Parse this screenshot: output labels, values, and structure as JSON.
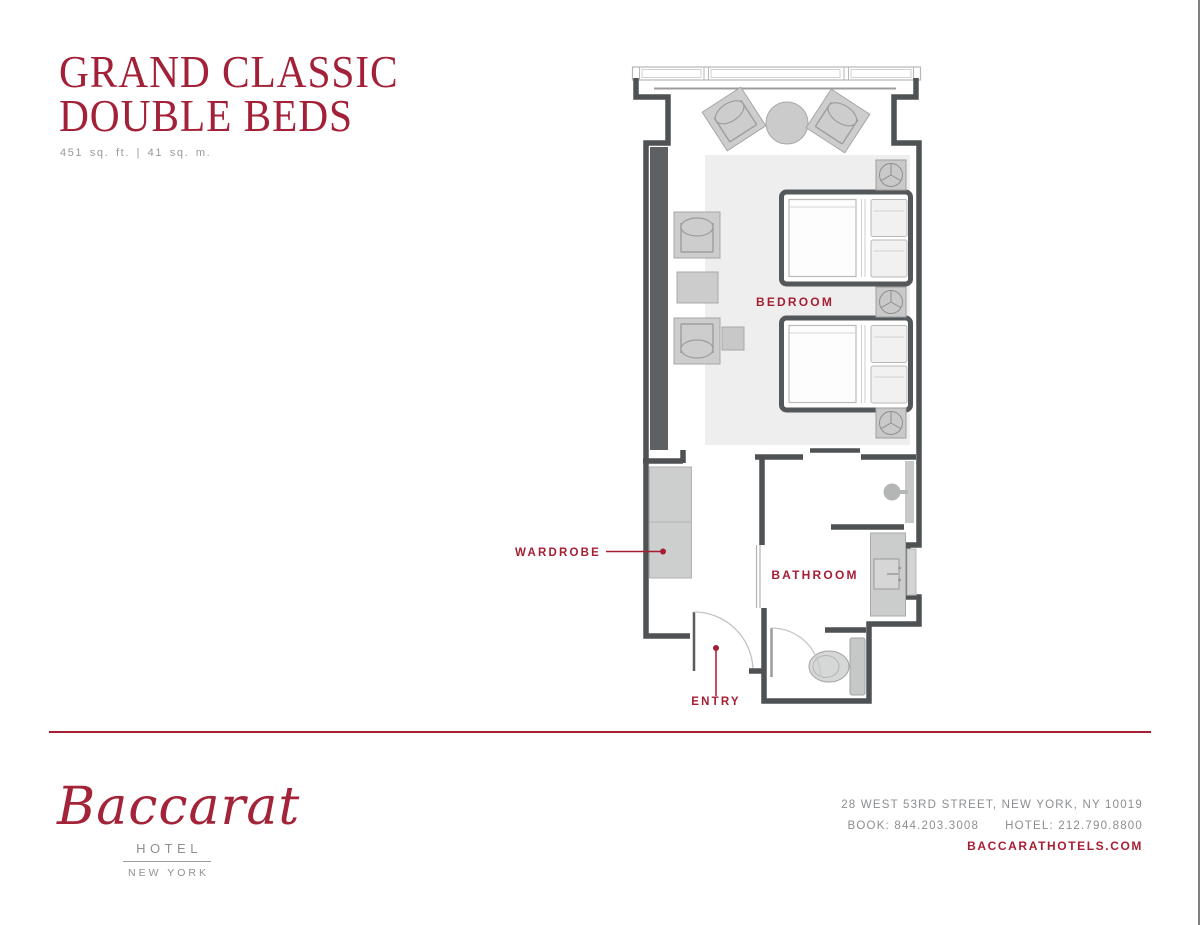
{
  "page": {
    "title_line1": "GRAND CLASSIC",
    "title_line2": "DOUBLE BEDS",
    "area": "451 sq. ft. | 41 sq. m."
  },
  "floorplan": {
    "bedroom_label": "BEDROOM",
    "bathroom_label": "BATHROOM",
    "wardrobe_label": "WARDROBE",
    "entry_label": "ENTRY",
    "colors": {
      "wall": "#4e5254",
      "accent": "#a51e33",
      "furniture": "#cccccc",
      "rug": "#eeeeef",
      "dark_panel": "#5e6163"
    }
  },
  "footer": {
    "brand_script": "Baccarat",
    "brand_sub": "HOTEL",
    "brand_city": "NEW YORK",
    "address": "28 WEST 53RD STREET, NEW YORK, NY 10019",
    "phone_book": "BOOK: 844.203.3008",
    "phone_hotel": "HOTEL: 212.790.8800",
    "website": "BACCARATHOTELS.COM"
  }
}
